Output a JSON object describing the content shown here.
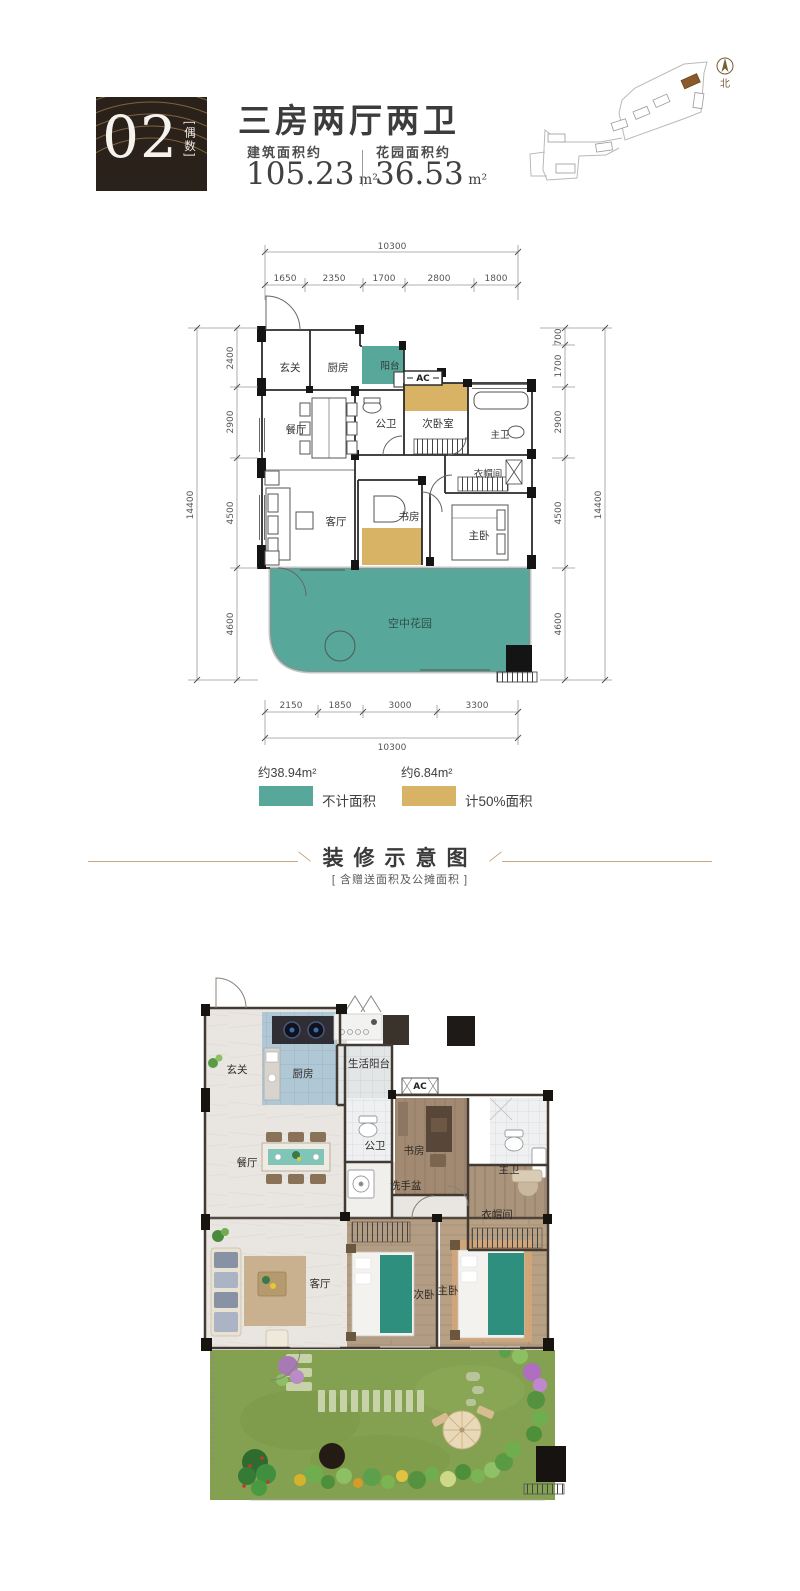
{
  "header": {
    "unit_number": "02",
    "unit_tag": "[偶数]",
    "title": "三房两厅两卫",
    "build_area_label": "建筑面积约",
    "build_area_value": "105.23",
    "build_area_unit": "m²",
    "garden_area_label": "花园面积约",
    "garden_area_value": "36.53",
    "garden_area_unit": "m²"
  },
  "site_map": {
    "north_label": "北"
  },
  "schematic": {
    "dims": {
      "top_total": "10300",
      "top": [
        "1650",
        "2350",
        "1700",
        "2800",
        "1800"
      ],
      "left_total": "14400",
      "left": [
        "2400",
        "2900",
        "4500",
        "4600"
      ],
      "right": [
        "700",
        "1700",
        "2900",
        "4500",
        "4600"
      ],
      "right_total": "14400",
      "bottom": [
        "2150",
        "1850",
        "3000",
        "3300"
      ],
      "bottom_total": "10300"
    },
    "rooms": {
      "entry": "玄关",
      "kitchen": "厨房",
      "balcony": "阳台",
      "ac": "AC",
      "guest_bath": "公卫",
      "second_bedroom": "次卧室",
      "master_bath": "主卫",
      "dining": "餐厅",
      "cloakroom": "衣帽间",
      "living": "客厅",
      "study": "书房",
      "master_bedroom": "主卧",
      "sky_garden": "空中花园"
    },
    "colors": {
      "not_counted": "#57a89a",
      "half_counted": "#d9b365"
    }
  },
  "legend": {
    "not_counted": {
      "area": "约38.94m²",
      "label": "不计面积",
      "color": "#57a89a"
    },
    "half_counted": {
      "area": "约6.84m²",
      "label": "计50%面积",
      "color": "#d9b365"
    }
  },
  "divider": {
    "title": "装修示意图",
    "subtitle": "[ 含赠送面积及公摊面积 ]"
  },
  "render": {
    "rooms": {
      "entry": "玄关",
      "kitchen": "厨房",
      "life_balcony": "生活阳台",
      "ac": "AC",
      "dining": "餐厅",
      "guest_bath": "公卫",
      "basin": "洗手盆",
      "study": "书房",
      "master_bath": "主卫",
      "cloakroom": "衣帽间",
      "living": "客厅",
      "second_bedroom": "次卧",
      "master_bedroom": "主卧"
    }
  }
}
